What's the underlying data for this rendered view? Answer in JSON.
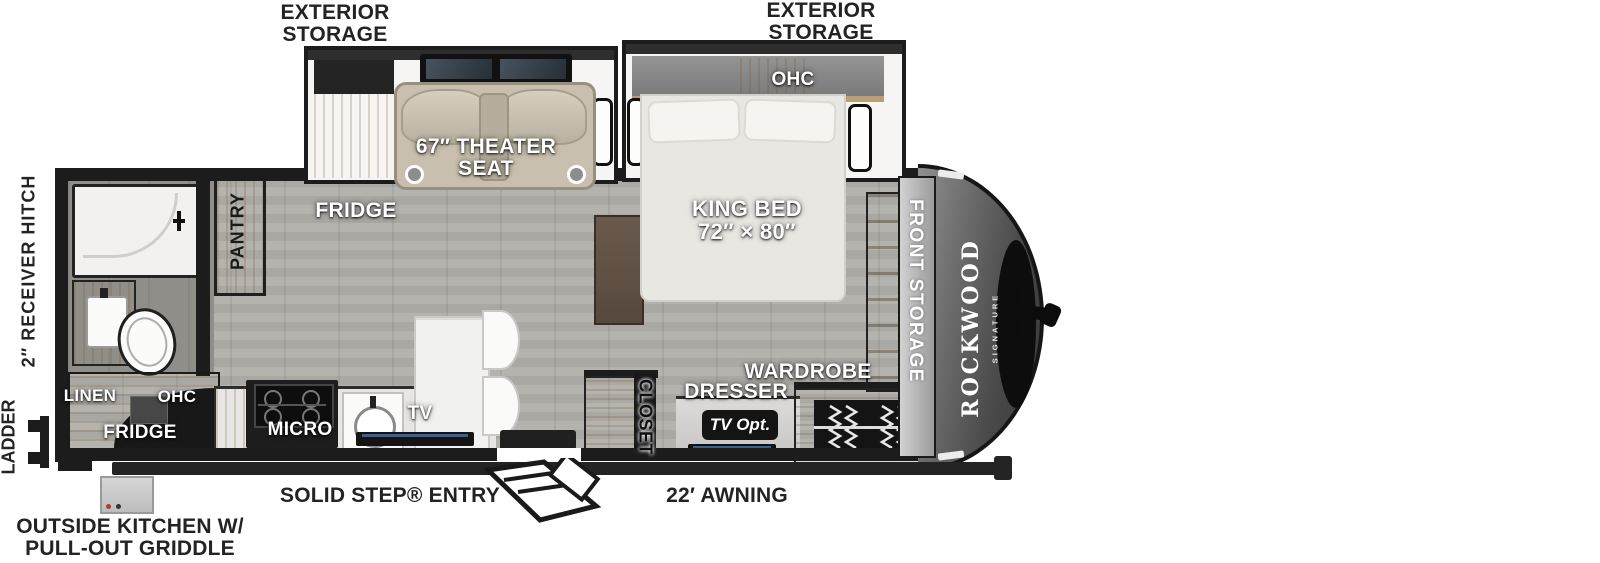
{
  "plan_title": "Rockwood Signature travel trailer floor plan",
  "brand": {
    "name": "ROCKWOOD",
    "series": "SIGNATURE"
  },
  "labels": {
    "exterior_storage_left": [
      "EXTERIOR",
      "STORAGE"
    ],
    "exterior_storage_right": [
      "EXTERIOR",
      "STORAGE"
    ],
    "theater_seat": [
      "67″ THEATER",
      "SEAT"
    ],
    "king_bed": [
      "KING BED",
      "72″ × 80″"
    ],
    "ohc_bedroom": "OHC",
    "fridge_main": "FRIDGE",
    "pantry": "PANTRY",
    "front_storage": "FRONT STORAGE",
    "closet": "CLOSET",
    "dresser": "DRESSER",
    "wardrobe": "WARDROBE",
    "tv_optional": "TV Opt.",
    "tv": "TV",
    "micro": "MICRO",
    "linen": "LINEN",
    "ohc_rear": "OHC",
    "fridge_outside": "FRIDGE",
    "solid_step_entry": "SOLID STEP® ENTRY",
    "awning": "22′ AWNING",
    "outside_kitchen": [
      "OUTSIDE KITCHEN W/",
      "PULL-OUT GRIDDLE"
    ],
    "ladder": "LADDER",
    "receiver_hitch": "2″ RECEIVER HITCH"
  },
  "colors": {
    "wall": "#1c1c1c",
    "floor_gray": "#b1afaa",
    "cabinet_wood": "#c9ae86",
    "theater_seat_beige": "#c8bfae",
    "front_cap_dark": "#3a3a3a",
    "floor_label_white": "#ffffff",
    "print_label_black": "#232323"
  }
}
